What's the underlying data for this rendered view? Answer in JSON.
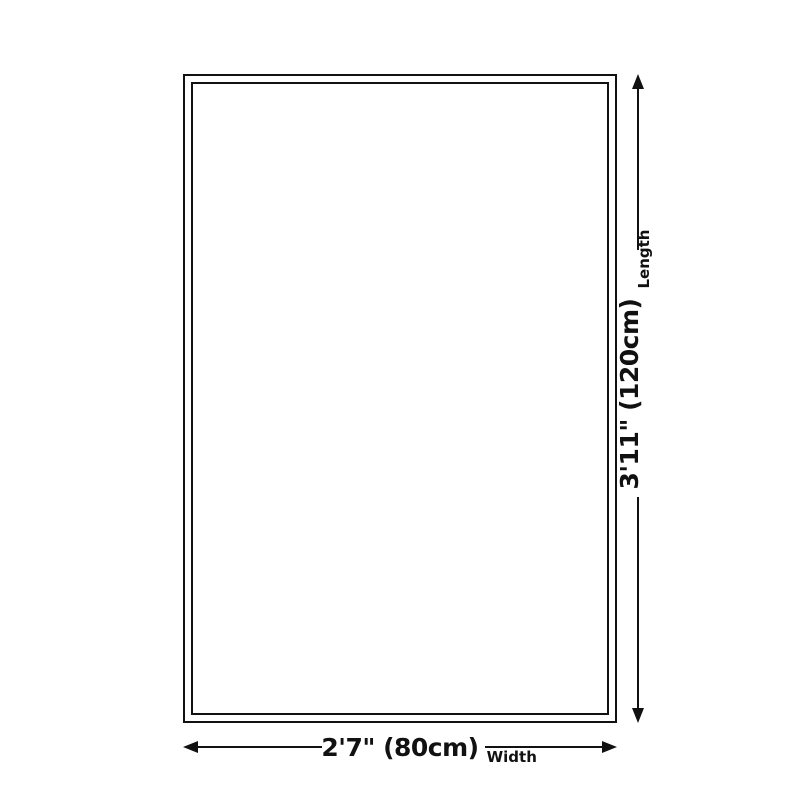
{
  "dimensions": {
    "length": {
      "value": "3'11\" (120cm)",
      "label": "Length"
    },
    "width": {
      "value": "2'7\" (80cm)",
      "label": "Width"
    }
  },
  "colors": {
    "ink": "#111111",
    "background": "#ffffff"
  }
}
